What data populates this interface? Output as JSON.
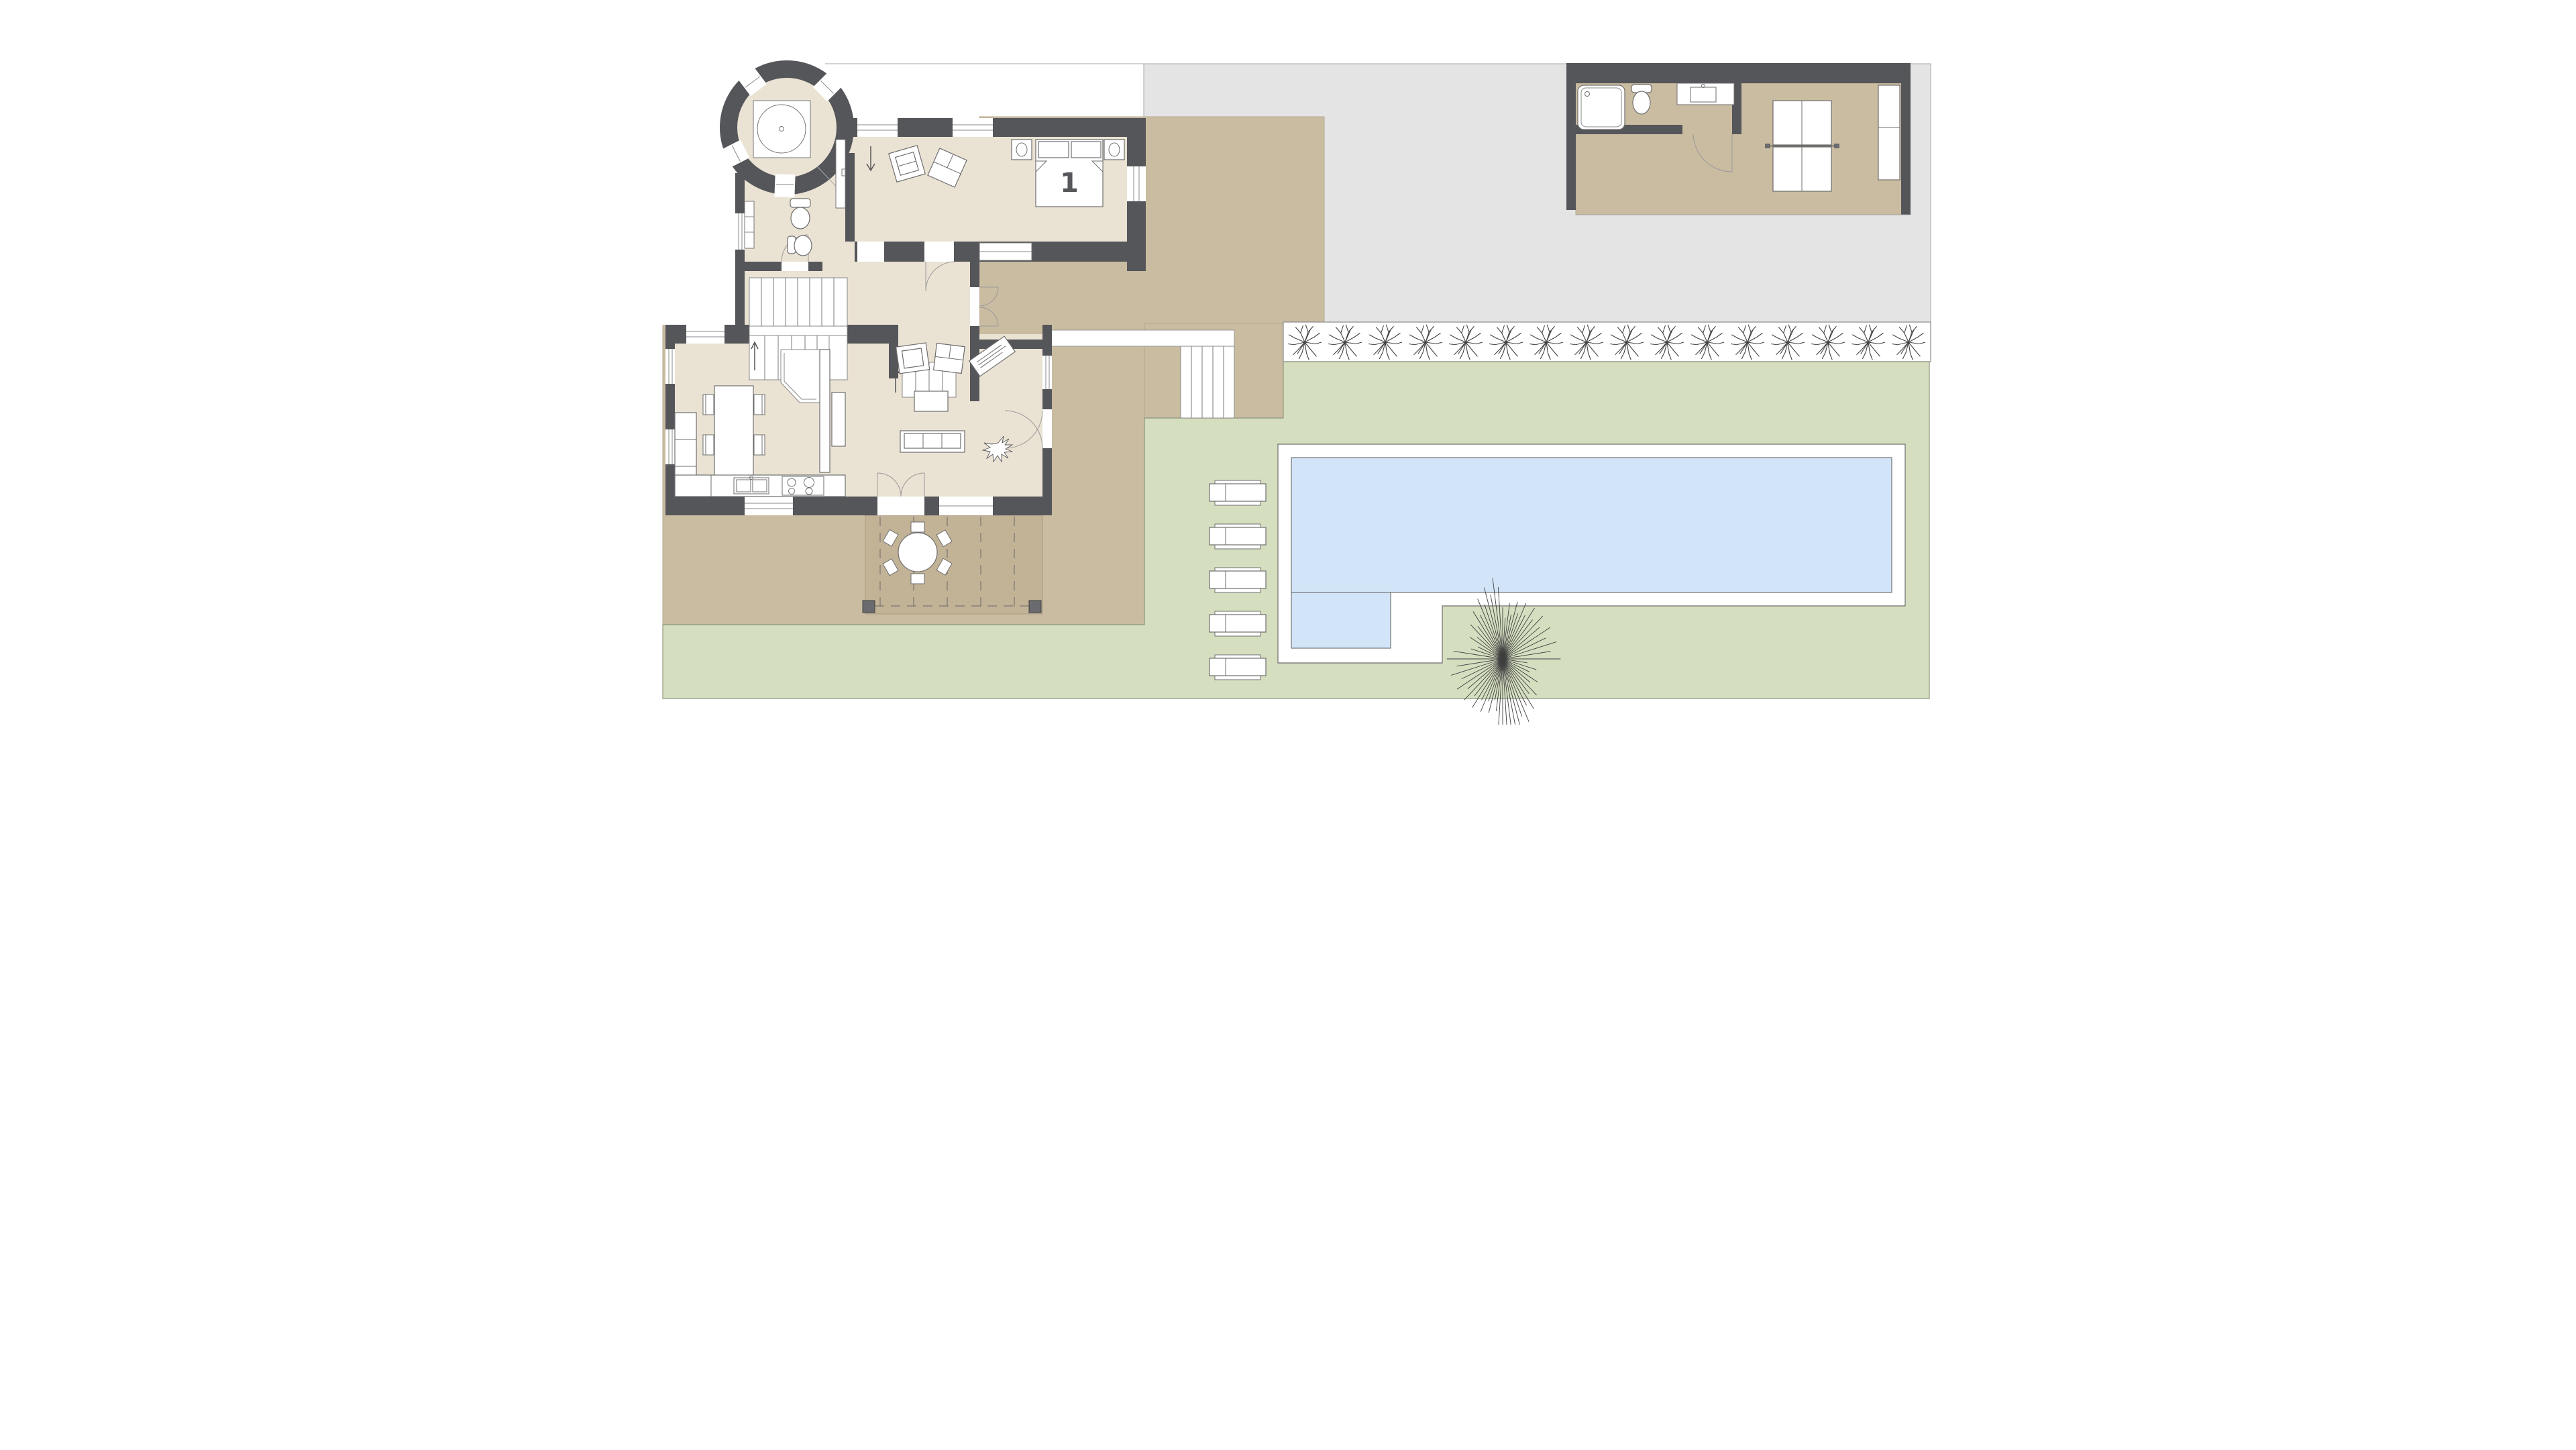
{
  "document": {
    "type": "architectural floor plan",
    "view": "ground floor site plan with garden, pool and annex",
    "visible_text": [
      "1"
    ]
  },
  "labels": {
    "bedroom_number": "1"
  },
  "colors": {
    "wall": "#55565a",
    "floor": "#eae2d3",
    "terrace": "#cabca1",
    "patio": "#c2b296",
    "driveway": "#e4e4e5",
    "lawn": "#d5dfc0",
    "water": "#d2e5f8",
    "deck": "#ffffff",
    "tanline": "#b3a78c",
    "treeline": "#3f3f3f"
  },
  "counts": {
    "hedge_shrubs": 16,
    "sun_loungers": 5,
    "tree_rays": 64,
    "dining_chairs": 6,
    "patio_chairs": 6,
    "stair_flights": 2,
    "tower_windows": 4,
    "pergola_posts": 2
  },
  "rooms": [
    {
      "name": "tower-spa-room",
      "features": [
        "hot-tub"
      ]
    },
    {
      "name": "bedroom",
      "label": "1",
      "features": [
        "double-bed",
        "two-nightstands-with-lamps",
        "two-armchairs",
        "window-seat"
      ]
    },
    {
      "name": "hall",
      "features": [
        "wc",
        "bidet",
        "vanity",
        "staircase-two-flights",
        "entry-steps",
        "wardrobe"
      ]
    },
    {
      "name": "dining-living-kitchen",
      "features": [
        "dining-table-6-chairs",
        "bay-window",
        "sideboard",
        "sofa",
        "coffee-table",
        "two-armchairs",
        "writing-desk",
        "plant",
        "kitchen-sink",
        "cooktop-4-burners"
      ]
    },
    {
      "name": "annex-garage",
      "features": [
        "bathtub",
        "wc",
        "vanity-sink",
        "ping-pong-table",
        "shelf-cabinet"
      ]
    }
  ],
  "outdoor": {
    "pool": {
      "shape": "L-shaped with step section",
      "deck": "white surround"
    },
    "pergola_patio": {
      "round_table": true,
      "chairs": 6
    },
    "hedge_row_shrubs": 16,
    "large_starburst_tree": true,
    "sun_loungers": 5,
    "areas": [
      "gray driveway",
      "tan terrace court",
      "green lawn"
    ]
  }
}
